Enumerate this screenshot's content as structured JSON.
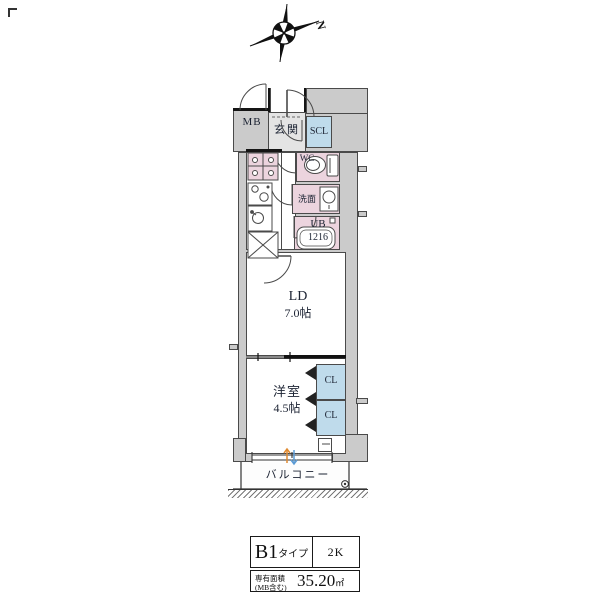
{
  "compass": {
    "north_label": "N"
  },
  "plan": {
    "labels": {
      "mb": "MB",
      "entrance": "玄関",
      "scl": "SCL",
      "wc": "WC",
      "washroom": "洗面",
      "bath_line1": "UB",
      "bath_line2": "1216",
      "living_line1": "LD",
      "living_line2": "7.0帖",
      "bedroom_line1": "洋室",
      "bedroom_line2": "4.5帖",
      "closet_upper": "CL",
      "closet_lower": "CL",
      "balcony": "バルコニー"
    },
    "colors": {
      "wall_gray": "#cbcbcb",
      "wet_pink": "#ecd4de",
      "closet_blue": "#bfdbeb",
      "entry_gray": "#e4e4e4",
      "outline": "#4a4a4a",
      "text_dark": "#1c2333",
      "accent_orange": "#e08a30",
      "accent_blue": "#5b9bd5"
    }
  },
  "info_table": {
    "type_value": "B1",
    "type_suffix": "タイプ",
    "layout_value": "2K",
    "area_label_line1": "専有面積",
    "area_label_line2": "(MB含む)",
    "area_value": "35.20",
    "area_unit": "㎡"
  }
}
